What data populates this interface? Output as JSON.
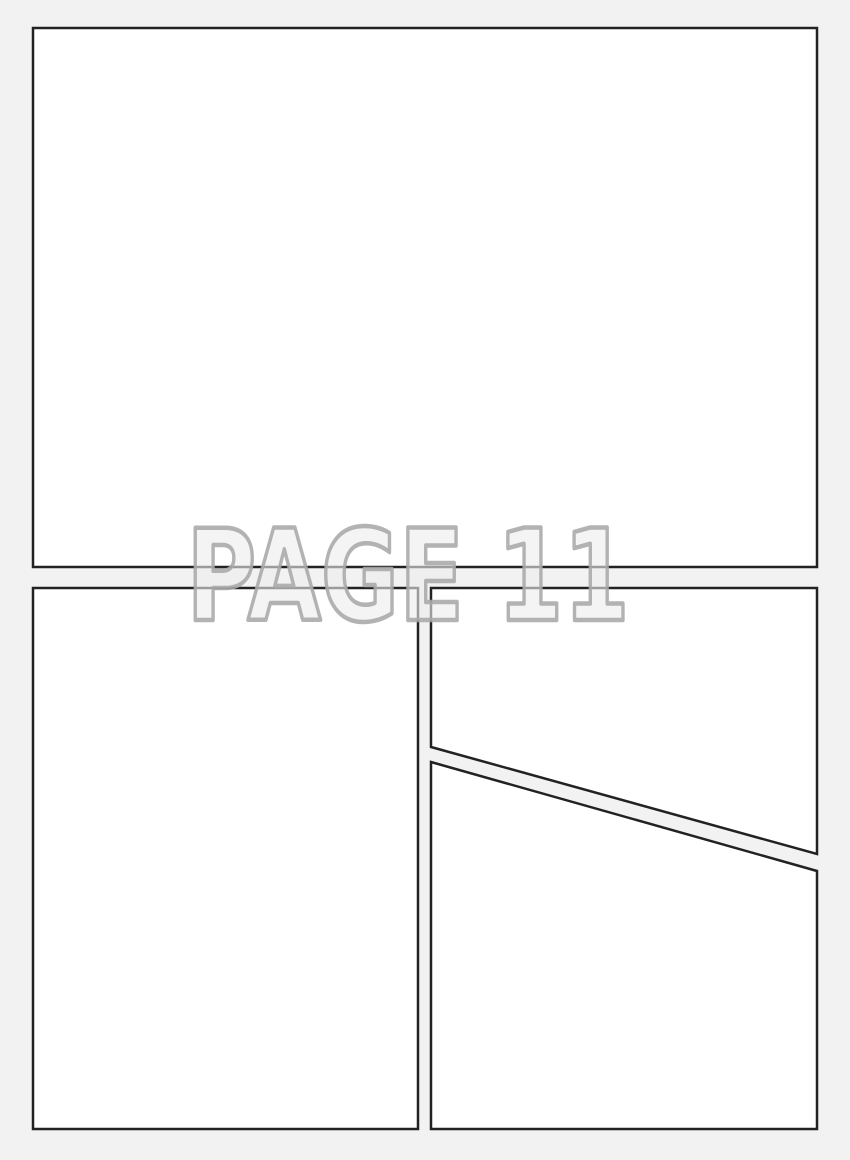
{
  "page": {
    "kind": "comic-page-template",
    "label": {
      "text": "PAGE 11"
    },
    "colors": {
      "background": "#f2f2f2",
      "panel_fill": "#ffffff",
      "panel_border": "#222222",
      "label_fill": "#ededed",
      "label_outline": "#a8a8a8"
    },
    "panel_count": 4
  }
}
